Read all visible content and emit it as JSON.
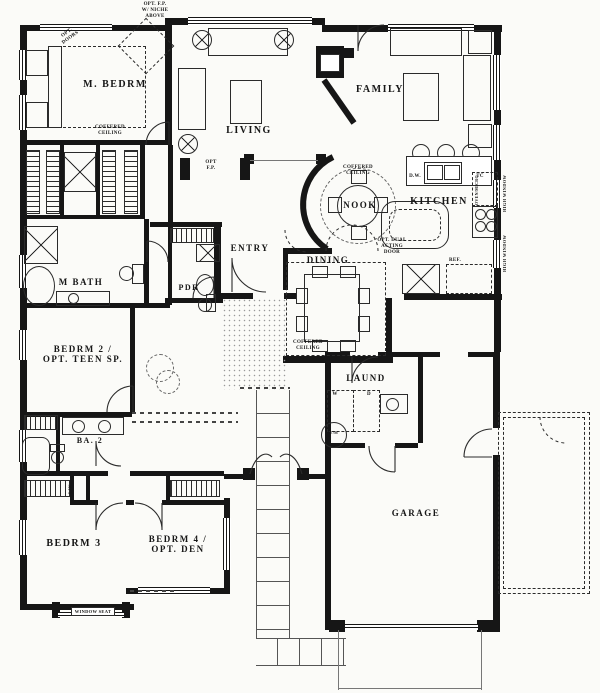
{
  "plan": {
    "rooms": {
      "m_bedrm": "M. BEDRM",
      "living": "LIVING",
      "family": "FAMILY",
      "nook": "NOOK",
      "kitchen": "KITCHEN",
      "entry": "ENTRY",
      "dining": "DINING",
      "pdr": "PDR",
      "m_bath": "M BATH",
      "bedrm2_line1": "BEDRM 2 /",
      "bedrm2_line2": "OPT. TEEN SP.",
      "ba2": "BA. 2",
      "laund": "LAUND",
      "bedrm3": "BEDRM 3",
      "bedrm4_line1": "BEDRM 4 /",
      "bedrm4_line2": "OPT. DEN",
      "garage": "GARAGE"
    },
    "annotations": {
      "opt_fp_niche_1": "OPT. F.P.",
      "opt_fp_niche_2": "W/ NICHE",
      "opt_fp_niche_3": "ABOVE",
      "opt_doors_1": "OPT.",
      "opt_doors_2": "DOORS",
      "coffered_1": "COFFERED",
      "coffered_2": "CEILING",
      "opt_fp_1": "OPT",
      "opt_fp_2": "F.P.",
      "opt_dual_1": "OPT. DUAL",
      "opt_dual_2": "ACTING",
      "opt_dual_3": "DOOR",
      "dishwasher": "D.W.",
      "trash_compactor": "TC",
      "refrigerator": "REF.",
      "washer": "W",
      "dryer": "D",
      "water_heater": "W/H",
      "oven": "OVEN/MICRO",
      "high_window": "HIGH WINDOW",
      "linen": "LIN",
      "window_seat": "WINDOW SEAT"
    },
    "colors": {
      "wall": "#161616",
      "line": "#2b2b2b",
      "paper": "#fbfbf8"
    }
  }
}
